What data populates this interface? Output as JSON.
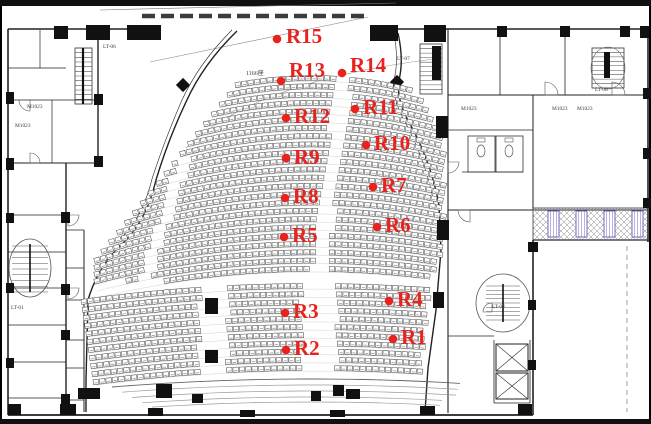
{
  "meta": {
    "width": 651,
    "height": 424,
    "accent_color": "#e8231e",
    "line_color": "#222222",
    "description_labels": "theater floor plan with acoustic measurement points"
  },
  "plan": {
    "seat_count_label": {
      "text": "1166座",
      "x": 246,
      "y": 75
    },
    "room_labels": [
      {
        "text": "LT-06",
        "x": 103,
        "y": 48
      },
      {
        "text": "LT-07",
        "x": 397,
        "y": 60
      },
      {
        "text": "LT-08",
        "x": 595,
        "y": 91
      },
      {
        "text": "LT-01",
        "x": 11,
        "y": 309
      },
      {
        "text": "LT-02",
        "x": 492,
        "y": 308
      },
      {
        "text": "M1023",
        "x": 27,
        "y": 108
      },
      {
        "text": "M1023",
        "x": 15,
        "y": 127
      },
      {
        "text": "M1023",
        "x": 461,
        "y": 110
      },
      {
        "text": "M1023",
        "x": 552,
        "y": 110
      },
      {
        "text": "M1023",
        "x": 577,
        "y": 110
      }
    ],
    "measurement_points": [
      {
        "id": "R1",
        "dot": [
          393,
          339
        ],
        "label": [
          401,
          344
        ]
      },
      {
        "id": "R2",
        "dot": [
          286,
          350
        ],
        "label": [
          294,
          355
        ]
      },
      {
        "id": "R3",
        "dot": [
          285,
          313
        ],
        "label": [
          293,
          318
        ]
      },
      {
        "id": "R4",
        "dot": [
          389,
          301
        ],
        "label": [
          397,
          306
        ]
      },
      {
        "id": "R5",
        "dot": [
          284,
          237
        ],
        "label": [
          292,
          242
        ]
      },
      {
        "id": "R6",
        "dot": [
          377,
          227
        ],
        "label": [
          385,
          232
        ]
      },
      {
        "id": "R7",
        "dot": [
          373,
          187
        ],
        "label": [
          381,
          192
        ]
      },
      {
        "id": "R8",
        "dot": [
          285,
          198
        ],
        "label": [
          293,
          203
        ]
      },
      {
        "id": "R9",
        "dot": [
          286,
          158
        ],
        "label": [
          294,
          164
        ]
      },
      {
        "id": "R10",
        "dot": [
          366,
          145
        ],
        "label": [
          374,
          150
        ]
      },
      {
        "id": "R11",
        "dot": [
          355,
          109
        ],
        "label": [
          363,
          114
        ]
      },
      {
        "id": "R12",
        "dot": [
          286,
          118
        ],
        "label": [
          294,
          123
        ]
      },
      {
        "id": "R13",
        "dot": [
          281,
          81
        ],
        "label": [
          289,
          77
        ]
      },
      {
        "id": "R14",
        "dot": [
          342,
          73
        ],
        "label": [
          350,
          72
        ]
      },
      {
        "id": "R15",
        "dot": [
          277,
          39
        ],
        "label": [
          286,
          43
        ]
      }
    ]
  }
}
